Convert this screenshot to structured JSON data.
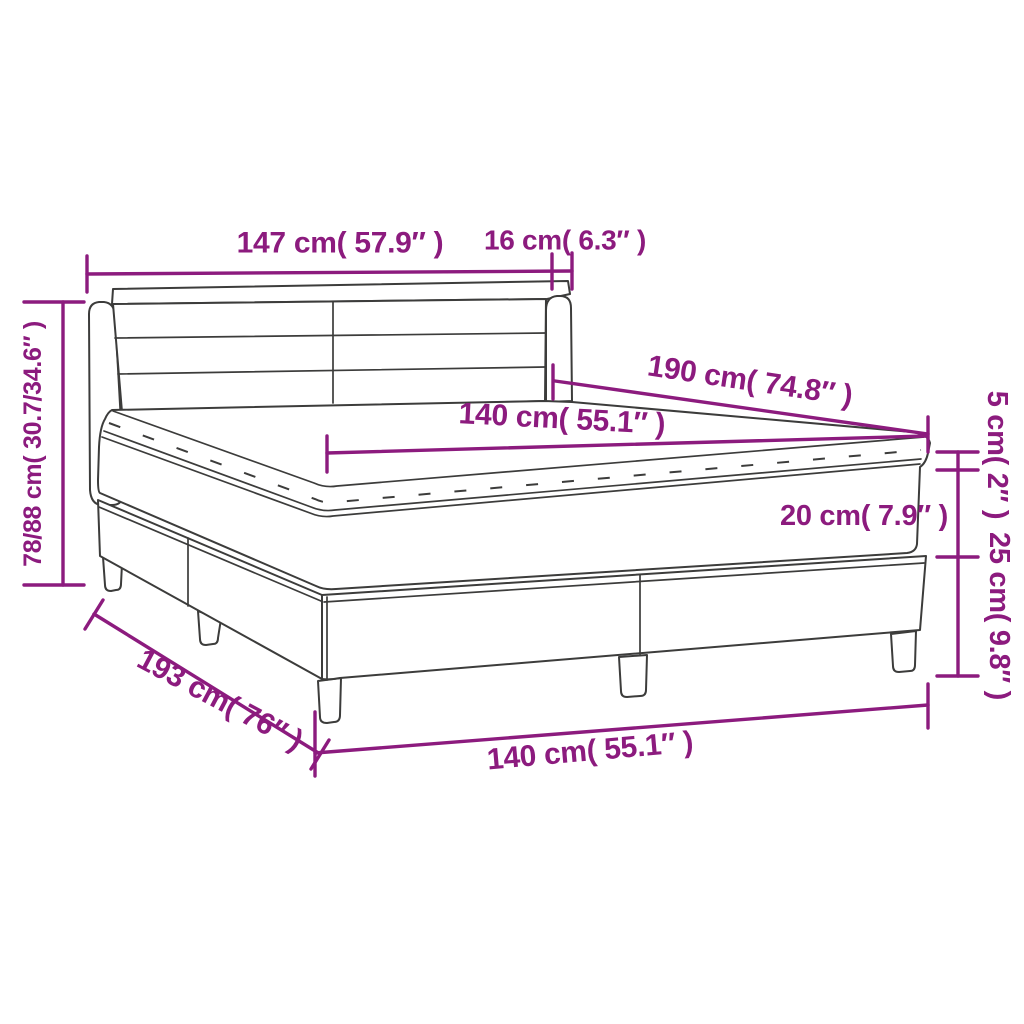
{
  "diagram": {
    "title": "Box spring bed with mattress and topper — dimension diagram",
    "colors": {
      "accent": "#8C1B7E",
      "line_art": "#3C3C3B",
      "background": "#FFFFFF"
    },
    "labels": {
      "headboard_width": "147 cm( 57.9″ )",
      "side_wing_width": "16 cm( 6.3″ )",
      "overall_height": "78/88 cm( 30.7/34.6″ )",
      "mattress_length": "190 cm( 74.8″ )",
      "mattress_width_top": "140 cm( 55.1″ )",
      "topper_height": "5 cm( 2″ )",
      "mattress_height": "20 cm( 7.9″ )",
      "base_height": "25 cm( 9.8″ )",
      "overall_length": "193 cm( 76″ )",
      "base_width": "140 cm( 55.1″ )"
    }
  }
}
